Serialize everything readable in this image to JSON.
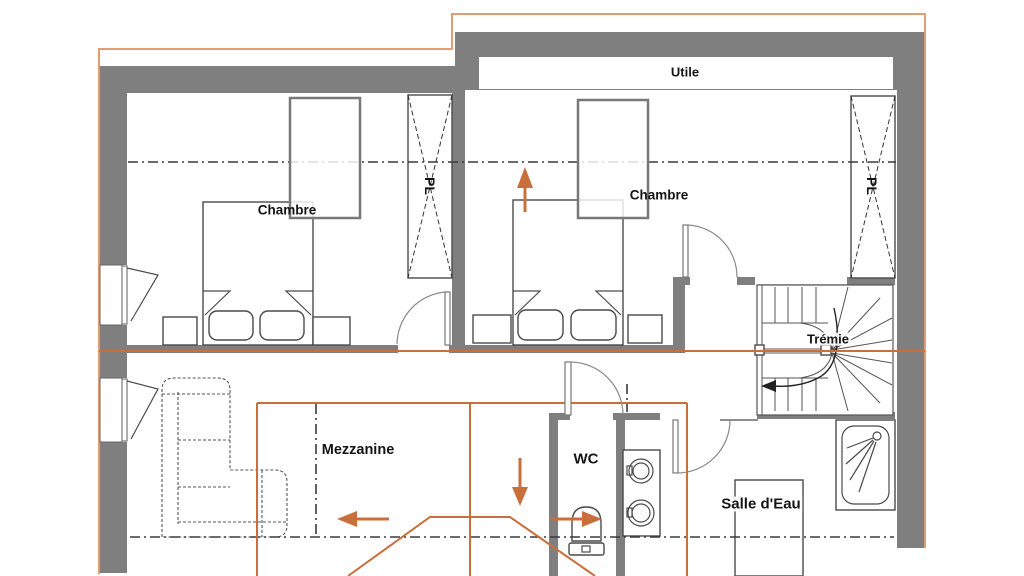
{
  "plan": {
    "type": "floor-plan",
    "labels": {
      "utile": "Utile",
      "chambre_left": "Chambre",
      "chambre_right": "Chambre",
      "pl_left": "PL",
      "pl_right": "PL",
      "tremie": "Trémie",
      "mezzanine": "Mezzanine",
      "wc": "WC",
      "salle_eau": "Salle d'Eau"
    },
    "colors": {
      "wall": "#7f7f7f",
      "accent": "#c86f3c",
      "outline": "#e39b72",
      "line": "#4a4a4a"
    }
  }
}
